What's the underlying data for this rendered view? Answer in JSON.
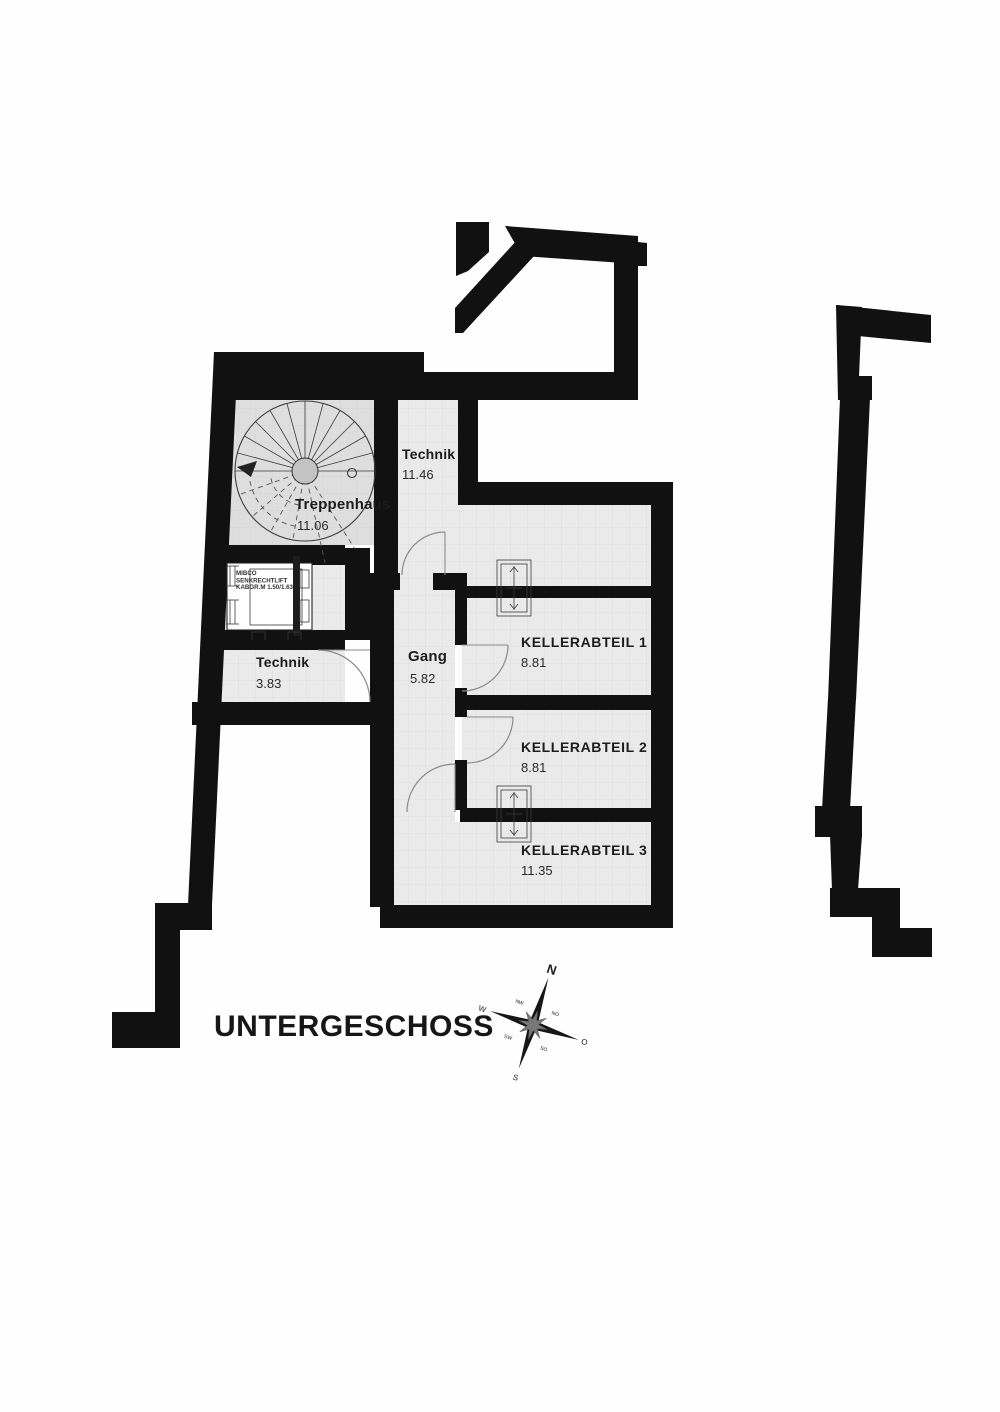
{
  "title": "UNTERGESCHOSS",
  "rooms": {
    "treppenhaus": {
      "name": "Treppenhaus",
      "area": "11.06"
    },
    "technik_og": {
      "name": "Technik",
      "area": "11.46"
    },
    "technik_ug": {
      "name": "Technik",
      "area": "3.83"
    },
    "gang": {
      "name": "Gang",
      "area": "5.82"
    },
    "keller1": {
      "name": "KELLERABTEIL 1",
      "area": "8.81"
    },
    "keller2": {
      "name": "KELLERABTEIL 2",
      "area": "8.81"
    },
    "keller3": {
      "name": "KELLERABTEIL 3",
      "area": "11.35"
    }
  },
  "lift": {
    "line1": "MIBCO",
    "line2": "SENKRECHTLIFT",
    "line3": "KABGR.M 1.50/1.63"
  },
  "compass": {
    "n": "N",
    "e": "O",
    "s": "S",
    "w": "W",
    "ne": "NO",
    "se": "SO",
    "sw": "SW",
    "nw": "NW"
  },
  "colors": {
    "wall": "#111111",
    "room": "#eaeaea",
    "room_dark": "#dedede",
    "grid": "#d8d8d8",
    "ink": "#1c1c1c"
  }
}
